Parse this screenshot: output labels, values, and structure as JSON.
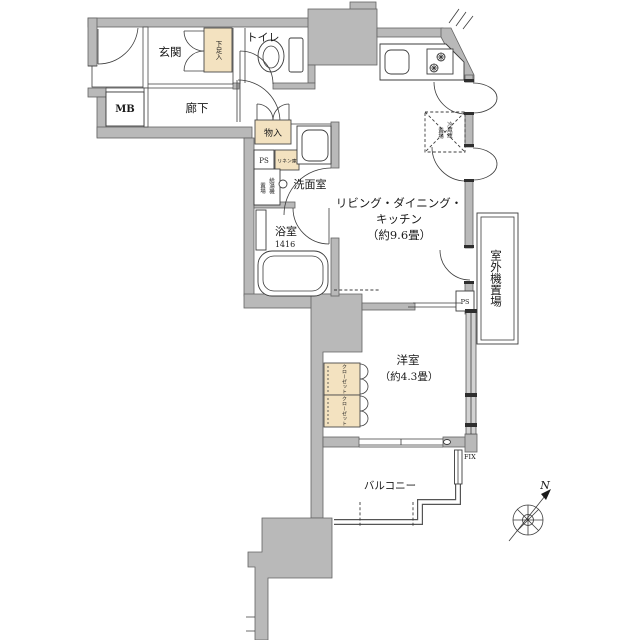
{
  "colors": {
    "wall_fill": "#b9b9b9",
    "wall_stroke": "#636363",
    "storage_beige": "#f3e2c0",
    "line": "#3c3c3c",
    "background": "#ffffff",
    "glass": "#d2d2d2"
  },
  "labels": {
    "genkan": "玄関",
    "shoebox": "下足入",
    "toilet": "トイレ",
    "mb": "MB",
    "corridor": "廊下",
    "storage": "物入",
    "ps_upper": "PS",
    "linen": "リネン庫",
    "water_heater_line1": "給湯機",
    "water_heater_line2": "置場",
    "washroom": "洗面室",
    "bathroom": "浴室",
    "bathroom_size": "1416",
    "ldk_line1": "リビング・ダイニング・",
    "ldk_line2": "キッチン",
    "ldk_line3": "（約9.6畳）",
    "fridge_line1": "冷蔵庫",
    "fridge_line2": "置場",
    "outdoor_unit": "室外機置場",
    "ps_lower": "PS",
    "western_room_line1": "洋室",
    "western_room_line2": "（約4.3畳）",
    "closet_upper": "クローゼット",
    "closet_lower": "クローゼット",
    "balcony": "バルコニー",
    "fix_window": "FIX",
    "compass_north": "N"
  }
}
